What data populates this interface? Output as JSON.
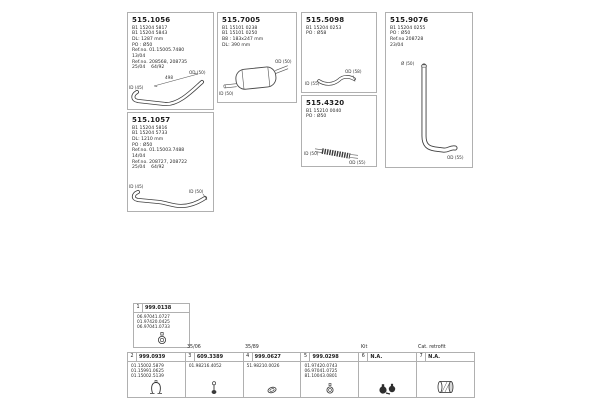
{
  "page": {
    "background": "#ffffff",
    "border_color": "#b0b0b0"
  },
  "boxes": [
    {
      "code": "515.1056",
      "lines": [
        "B1 15204 5817",
        "B1 15204 5843",
        "DL: 1287 mm",
        "PO : Ø50",
        "Ref.no. 01.15005.7480",
        "13/04",
        "Ref.no. 208568, 208735",
        "25/04    64/92"
      ],
      "diagram": {
        "dim": "498",
        "left_label": "ID (45)",
        "right_label": "OD (50)"
      }
    },
    {
      "code": "515.1057",
      "lines": [
        "B1 15204 5816",
        "B1 15204 5733",
        "DL: 1210 mm",
        "PO : Ø50",
        "Ref.no. 01.15003.7488",
        "14/04",
        "Ref.no. 208727, 208722",
        "25/04    64/92"
      ],
      "diagram": {
        "left_label": "ID (45)",
        "right_label": "ID (50)"
      }
    },
    {
      "code": "515.7005",
      "lines": [
        "B1 15101 0238",
        "B1 15101 0250",
        "B8 : 183x247 mm",
        "DL: 390 mm"
      ],
      "diagram": {
        "left_label": "ID (50)",
        "right_label": "OD (50)"
      }
    },
    {
      "code": "515.5098",
      "lines": [
        "B1 15204 0253",
        "PO : Ø58"
      ],
      "diagram": {
        "left_label": "ID (55)",
        "right_label": "OD (58)"
      }
    },
    {
      "code": "515.4320",
      "lines": [
        "B1 15210 0040",
        "PO : Ø50"
      ],
      "diagram": {
        "left_label": "ID (50)",
        "right_label": "OD (55)"
      }
    },
    {
      "code": "515.9076",
      "lines": [
        "B1 15204 0255",
        "PO : Ø50",
        "Ref.no 208728",
        "23/04"
      ],
      "diagram": {
        "left_label": "Ø (50)",
        "right_label": "OD (55)"
      }
    }
  ],
  "fitting_box": {
    "num": "1",
    "code": "999.0138",
    "lines": [
      "06.97041.0727",
      "01.97420.0425",
      "06.97041.0733"
    ]
  },
  "table": {
    "top_labels": [
      {
        "text": "35/06"
      },
      {
        "text": "35/89"
      },
      {
        "text": "Kit"
      },
      {
        "text": "Cat. retrofit"
      }
    ],
    "cells": [
      {
        "num": "2",
        "code": "999.0939",
        "lines": [
          "01.15002.5879",
          "01.15991.0625",
          "01.15002.5139"
        ]
      },
      {
        "num": "3",
        "code": "609.3389",
        "lines": [
          "01.98216.4052"
        ]
      },
      {
        "num": "4",
        "code": "999.0627",
        "lines": [
          "51.98210.0026"
        ]
      },
      {
        "num": "5",
        "code": "999.0298",
        "lines": [
          "01.97420.0743",
          "06.97041.0725",
          "81.10043.0801"
        ]
      },
      {
        "num": "6",
        "code": "N.A.",
        "lines": []
      },
      {
        "num": "7",
        "code": "N.A.",
        "lines": []
      }
    ]
  }
}
